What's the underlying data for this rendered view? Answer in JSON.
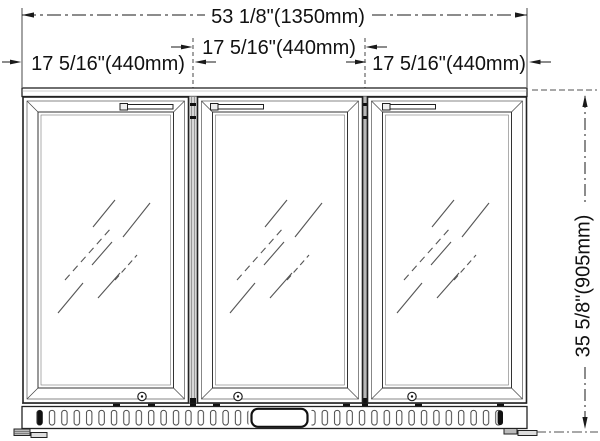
{
  "drawing": {
    "dimensions": {
      "overall_width": "53 1/8\"(1350mm)",
      "door_widths": [
        "17 5/16\"(440mm)",
        "17 5/16\"(440mm)",
        "17 5/16\"(440mm)"
      ],
      "height": "35 5/8\"(905mm)"
    },
    "colors": {
      "line": "#1a1a1a",
      "background": "#ffffff",
      "mullion_shade": "#d8d8d8"
    }
  }
}
